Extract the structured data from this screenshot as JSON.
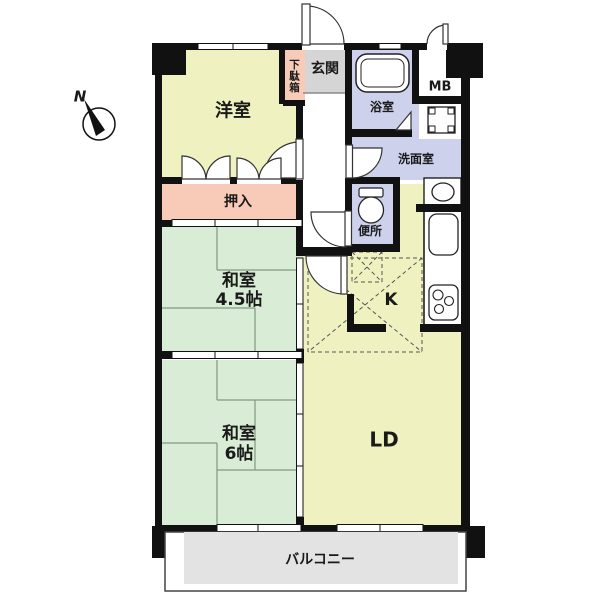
{
  "diagram_type": "apartment-floor-plan",
  "compass": {
    "label": "N"
  },
  "rooms": {
    "yoshitsu": {
      "label": "洋室"
    },
    "getabako": {
      "label": "下駄箱"
    },
    "genkan": {
      "label": "玄関"
    },
    "yokushitsu": {
      "label": "浴室"
    },
    "mb": {
      "label": "MB"
    },
    "senmenshitsu": {
      "label": "洗面室"
    },
    "benjo": {
      "label": "便所"
    },
    "oshiire": {
      "label": "押入"
    },
    "washitsu45": {
      "label_line1": "和室",
      "label_line2": "4.5帖"
    },
    "kitchen": {
      "label": "K"
    },
    "washitsu6": {
      "label_line1": "和室",
      "label_line2": "6帖"
    },
    "ld": {
      "label": "LD"
    },
    "balcony": {
      "label": "バルコニー"
    }
  },
  "fixtures": [
    "bathtub",
    "washing-machine",
    "toilet",
    "wash-basin",
    "kitchen-sink",
    "stove",
    "refrigerator-space"
  ],
  "colors": {
    "room_yellow": "#eff2c0",
    "tatami_green": "#d9edd6",
    "closet_pink": "#f8cab8",
    "wet_area_lavender": "#cdd1eb",
    "entry_gray": "#d5d5d5",
    "balcony_gray": "#e3e3e3",
    "wall": "#111111"
  }
}
